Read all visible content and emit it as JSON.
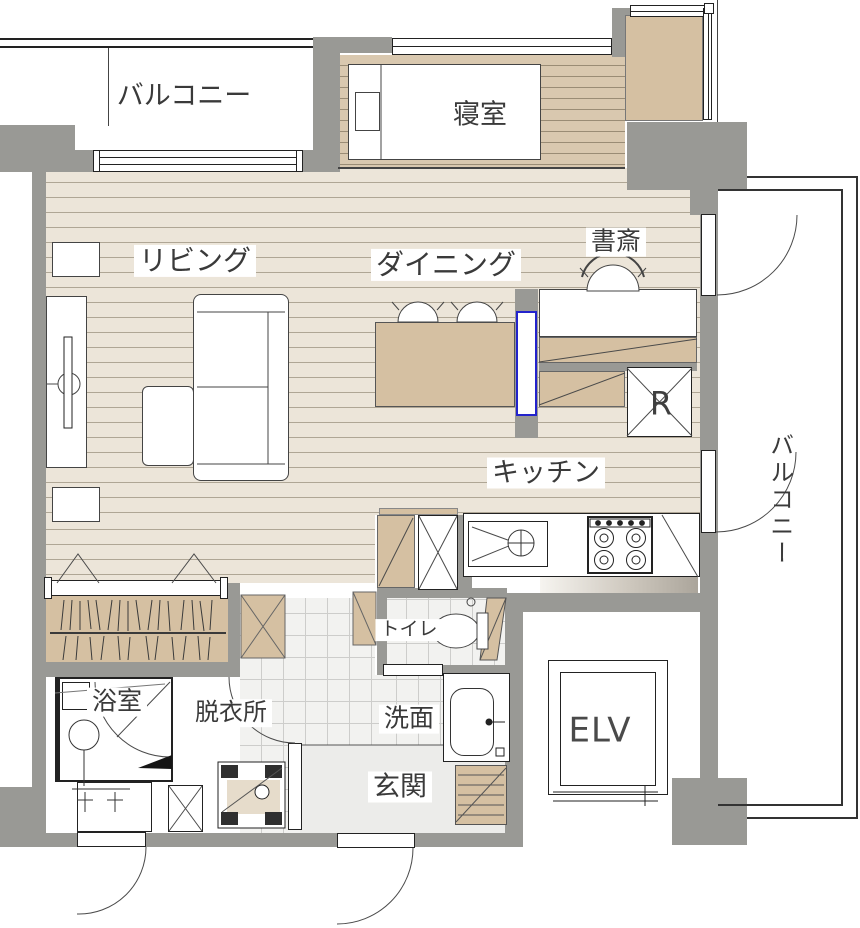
{
  "rooms": {
    "balcony_top": {
      "label": "バルコニー"
    },
    "bedroom": {
      "label": "寝室"
    },
    "living": {
      "label": "リビング"
    },
    "dining": {
      "label": "ダイニング"
    },
    "study": {
      "label": "書斎"
    },
    "kitchen": {
      "label": "キッチン"
    },
    "balcony_right": {
      "label": "バルコニー"
    },
    "toilet": {
      "label": "トイレ"
    },
    "bathroom": {
      "label": "浴室"
    },
    "dressing_room": {
      "label": "脱衣所"
    },
    "washroom": {
      "label": "洗面"
    },
    "entrance": {
      "label": "玄関"
    },
    "elevator": {
      "label": "ELV"
    },
    "refrigerator": {
      "label": "R"
    }
  },
  "colors": {
    "wall": "#999995",
    "floor_light": "#ECE5D9",
    "floor_light_line": "#AFA695",
    "floor_dark": "#D9C8AF",
    "floor_dark_line": "#9A8C75",
    "tan": "#D5C0A2",
    "tile": "#F2F2F0",
    "tile_line": "#CDCDCB",
    "entry": "#ECECEA",
    "line": "#3F3F3F",
    "label": "#3A3A3A",
    "blue": "#2323CC"
  }
}
